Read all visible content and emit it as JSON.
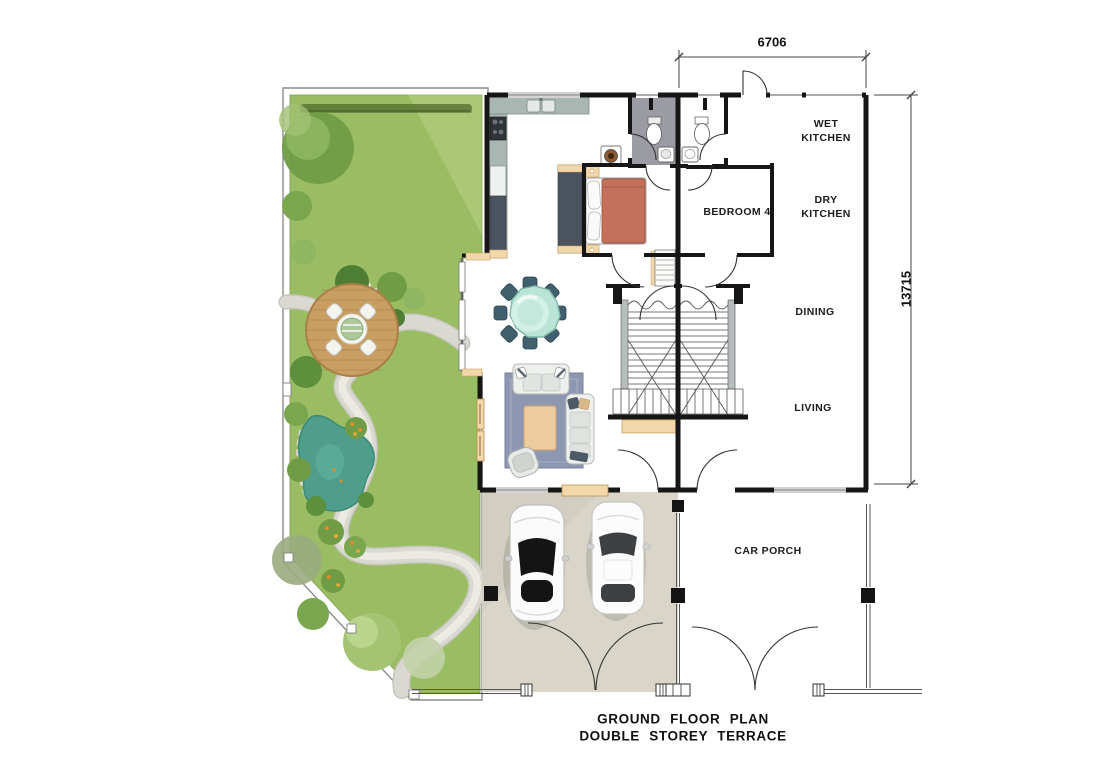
{
  "plan": {
    "title_line1": "GROUND FLOOR PLAN",
    "title_line2": "DOUBLE STOREY TERRACE"
  },
  "dimensions": {
    "top_width": "6706",
    "right_height": "13715"
  },
  "room_labels": {
    "wet_kitchen": "WET\nKITCHEN",
    "dry_kitchen": "DRY\nKITCHEN",
    "bedroom4": "BEDROOM 4",
    "dining": "DINING",
    "living": "LIVING",
    "car_porch": "CAR PORCH"
  },
  "colors": {
    "lawn": "#9abc62",
    "lawn_light": "#bcd48b",
    "hedge": "#55712f",
    "path": "#d9d9d2",
    "pond": "#4f9e8c",
    "deck": "#c89e62",
    "wall": "#161616",
    "bath_floor": "#9b9ba3",
    "counter": "#aab6b2",
    "cabinet": "#4a545e",
    "timber": "#f2d7ab",
    "bed": "#c4705a",
    "rug": "#8e97b2",
    "table_glass": "#b9e4d6",
    "chair": "#41606d",
    "porch_floor": "#d9d5c9",
    "sofa": "#eef0ee"
  }
}
